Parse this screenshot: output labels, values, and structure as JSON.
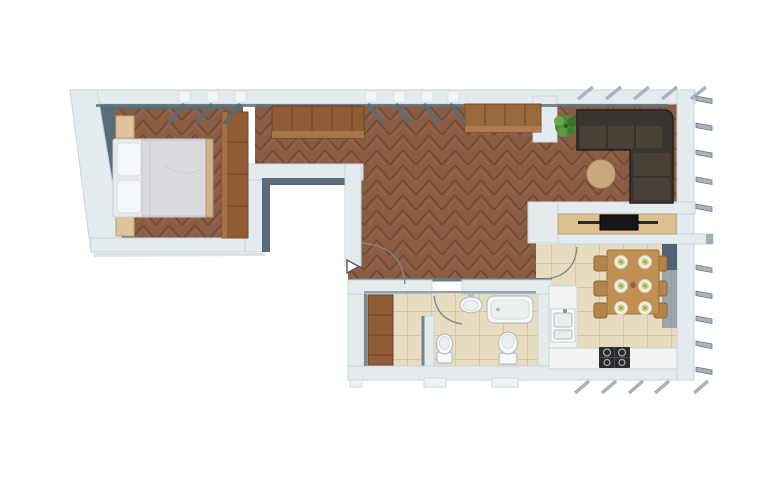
{
  "scene": {
    "type": "apartment-floor-plan-3d-top-view",
    "rooms": [
      {
        "name": "bedroom",
        "furniture": [
          "double-bed",
          "pillows",
          "nightstand-left",
          "nightstand-right",
          "wardrobe"
        ]
      },
      {
        "name": "corridor-hall",
        "furniture": [
          "wardrobe-cabinet"
        ],
        "markers": [
          "entrance-arrow",
          "entrance-door-arc"
        ]
      },
      {
        "name": "living-room",
        "furniture": [
          "corner-sofa",
          "round-rug",
          "plant",
          "sideboard",
          "tv-console",
          "tv",
          "soundbar"
        ]
      },
      {
        "name": "kitchen-dining",
        "furniture": [
          "dining-table",
          "six-chairs",
          "six-place-settings",
          "counter-with-sink",
          "counter-with-cooktop"
        ]
      },
      {
        "name": "bathroom",
        "furniture": [
          "bathtub",
          "washbasin",
          "toilet",
          "bidet",
          "wardrobe"
        ]
      }
    ],
    "markers": [
      "open-window-shutters-top",
      "balcony-brackets-right",
      "shutters-bottom",
      "door-swing-arcs"
    ]
  },
  "palette": {
    "background": "#ffffff",
    "wall": "#e4ebee",
    "wall_edge": "#c9d4da",
    "wall_shadow": "#5b6c79",
    "wood_floor": "#8a5c44",
    "wood_floor_line": "#6b4633",
    "wood_floor_highlight": "#a0715a",
    "wardrobe_wood": "#8f5c36",
    "sideboard_wood": "#9a6a3e",
    "console_wood": "#dcc08e",
    "nightstand": "#dec49a",
    "bed_frame": "#cdb48c",
    "bed_blanket": "#d9dade",
    "bed_pillow": "#f5f6f8",
    "tile": "#e8dcc0",
    "tile_line": "#d6c5a3",
    "sofa": "#393530",
    "sofa_cushion": "#474138",
    "rug": "#c9a97b",
    "plant": "#4d8c38",
    "tv": "#17171a",
    "table_wood": "#c08f52",
    "chair": "#b4854a",
    "plate_rim": "#f0efe8",
    "plate_center": "#cbcb7c",
    "counter": "#f2f4f3",
    "cooktop": "#2c2c2e",
    "fixture": "#f7f8f8",
    "shutter_dark": "#5a6b78",
    "shutter_light": "#a7b4be",
    "corner_shadow": "#4f6377"
  }
}
